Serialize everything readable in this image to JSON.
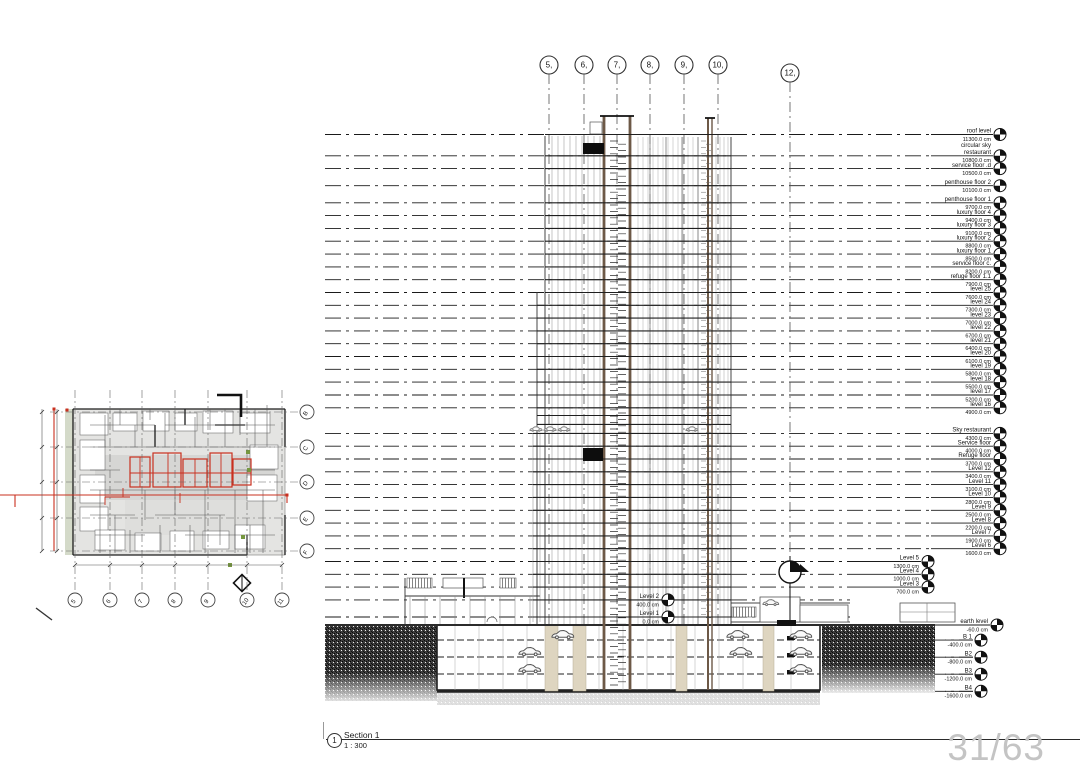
{
  "sheet": {
    "page_number": "31/63",
    "title_block": {
      "detail_number": "1",
      "view_name": "Section 1",
      "scale": "1 : 300"
    }
  },
  "grid_bubbles_top": {
    "labels": [
      "5,",
      "6,",
      "7,",
      "8,",
      "9,",
      "10,",
      "12,"
    ]
  },
  "plan": {
    "bottom_bubbles": [
      "5",
      "6",
      "7",
      "8",
      "9",
      "10",
      "11"
    ],
    "side_bubbles": [
      "B",
      "C",
      "D",
      "E",
      "F"
    ]
  },
  "colors": {
    "line": "#1a1a1a",
    "core_brown": "#6d5947",
    "column_beige": "#ded5c0",
    "section_red": "#c9301f",
    "landscape_green": "#76973f",
    "page_number_gray": "#c4c4c4"
  },
  "levels": [
    {
      "name": "roof level",
      "elev": "11300.0 cm",
      "cm": 11300,
      "g": "d"
    },
    {
      "pre": "circular sky",
      "name": "restaurant",
      "elev": "10800.0 cm",
      "cm": 10800,
      "g": "d"
    },
    {
      "name": "service floor .d",
      "elev": "10500.0 cm",
      "cm": 10500,
      "g": "d"
    },
    {
      "name": "penthouse floor 2",
      "elev": "10100.0 cm",
      "cm": 10100,
      "g": "d"
    },
    {
      "name": "penthouse floor 1",
      "elev": "9700.0 cm",
      "cm": 9700,
      "g": "d"
    },
    {
      "name": "luxury floor 4",
      "elev": "9400.0 cm",
      "cm": 9400,
      "g": "d"
    },
    {
      "name": "luxury floor 3",
      "elev": "9100.0 cm",
      "cm": 9100,
      "g": "d"
    },
    {
      "name": "luxury floor 2",
      "elev": "8800.0 cm",
      "cm": 8800,
      "g": "d"
    },
    {
      "name": "luxury floor 1",
      "elev": "8500.0 cm",
      "cm": 8500,
      "g": "d"
    },
    {
      "name": "service floor c.",
      "elev": "8200.0 cm",
      "cm": 8200,
      "g": "d"
    },
    {
      "name": "refuge floor 1.1",
      "elev": "7900.0 cm",
      "cm": 7900,
      "g": "d"
    },
    {
      "name": "level 25",
      "elev": "7600.0 cm",
      "cm": 7600,
      "g": "d"
    },
    {
      "name": "level 24",
      "elev": "7300.0 cm",
      "cm": 7300,
      "g": "d"
    },
    {
      "name": "level 23",
      "elev": "7000.0 cm",
      "cm": 7000,
      "g": "d"
    },
    {
      "name": "level 22",
      "elev": "6700.0 cm",
      "cm": 6700,
      "g": "d"
    },
    {
      "name": "level 21",
      "elev": "6400.0 cm",
      "cm": 6400,
      "g": "d"
    },
    {
      "name": "level 20",
      "elev": "6100.0 cm",
      "cm": 6100,
      "g": "d"
    },
    {
      "name": "level 19",
      "elev": "5800.0 cm",
      "cm": 5800,
      "g": "d"
    },
    {
      "name": "level 18",
      "elev": "5500.0 cm",
      "cm": 5500,
      "g": "d"
    },
    {
      "name": "level 17",
      "elev": "5200.0 cm",
      "cm": 5200,
      "g": "d"
    },
    {
      "name": "level 16",
      "elev": "4900.0 cm",
      "cm": 4900,
      "g": "d"
    },
    {
      "name": "Sky restaurant",
      "elev": "4300.0 cm",
      "cm": 4300,
      "g": "d"
    },
    {
      "name": "Service floor",
      "elev": "4000.0 cm",
      "cm": 4000,
      "g": "d"
    },
    {
      "name": "Refuge floor",
      "elev": "3700.0 cm",
      "cm": 3700,
      "g": "d"
    },
    {
      "name": "Level 12",
      "elev": "3400.0 cm",
      "cm": 3400,
      "g": "d"
    },
    {
      "name": "Level 11",
      "elev": "3100.0 cm",
      "cm": 3100,
      "g": "d"
    },
    {
      "name": "Level 10",
      "elev": "2800.0 cm",
      "cm": 2800,
      "g": "d"
    },
    {
      "name": "Level 9",
      "elev": "2500.0 cm",
      "cm": 2500,
      "g": "d"
    },
    {
      "name": "Level 8",
      "elev": "2200.0 cm",
      "cm": 2200,
      "g": "d"
    },
    {
      "name": "Level 7",
      "elev": "1900.0 cm",
      "cm": 1900,
      "g": "d"
    },
    {
      "name": "Level 6",
      "elev": "1600.0 cm",
      "cm": 1600,
      "g": "d"
    },
    {
      "name": "Level 5",
      "elev": "1300.0 cm",
      "cm": 1300,
      "g": "s"
    },
    {
      "name": "Level 4",
      "elev": "1000.0 cm",
      "cm": 1000,
      "g": "s"
    },
    {
      "name": "Level 3",
      "elev": "700.0 cm",
      "cm": 700,
      "g": "s"
    },
    {
      "name": "Level 2",
      "elev": "400.0 cm",
      "cm": 400,
      "g": "m"
    },
    {
      "name": "Level 1",
      "elev": "0.0 cm",
      "cm": 0,
      "g": "m"
    },
    {
      "name": "earth level",
      "elev": "-60.0 cm",
      "cm": -60,
      "g": "e"
    },
    {
      "name": "B 1",
      "elev": "-400.0 cm",
      "cm": -400,
      "g": "b"
    },
    {
      "name": "B2",
      "elev": "-800.0 cm",
      "cm": -800,
      "g": "b"
    },
    {
      "name": "B3",
      "elev": "-1200.0 cm",
      "cm": -1200,
      "g": "b"
    },
    {
      "name": "B4",
      "elev": "-1600.0 cm",
      "cm": -1600,
      "g": "b"
    }
  ]
}
